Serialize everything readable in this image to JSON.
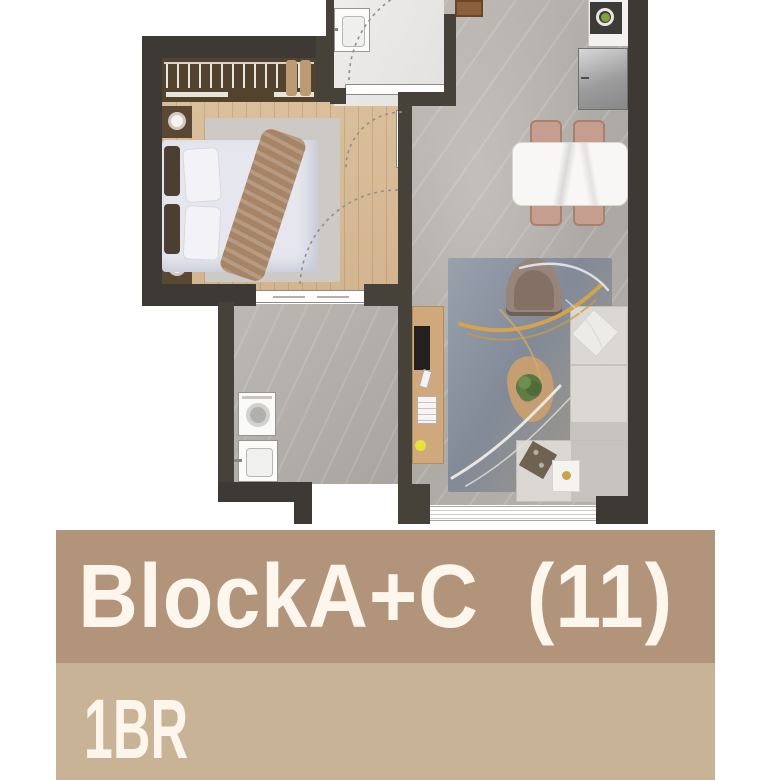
{
  "banner": {
    "block_line": "BlockA+C  (11)",
    "type_line": "1BR",
    "bar1_color": "#b2947a",
    "bar2_color": "#c9b396",
    "text_color": "#fcf6ec"
  },
  "floor_plan": {
    "rooms": [
      "bedroom",
      "wardrobe",
      "bathroom",
      "hallway",
      "entry",
      "kitchen",
      "dining-area",
      "living-area",
      "laundry-bathroom"
    ],
    "furniture": [
      "wardrobe-hangers",
      "double-bed",
      "nightstand-lamps",
      "bathroom-sink",
      "entry-doormat",
      "kitchen-sink",
      "refrigerator",
      "dining-table",
      "dining-chairs",
      "area-rug",
      "armchair",
      "coffee-table",
      "plant",
      "sectional-sofa",
      "side-table",
      "tv-console",
      "washing-machine",
      "laundry-sink",
      "window",
      "door-swing-arcs"
    ],
    "colors": {
      "wall": "#474239",
      "wood_floor": "#d8bd99",
      "tile_floor": "#b6b2ae",
      "bathroom_floor": "#e9e8e5",
      "rug_blue": "#8b92a0",
      "feather_gold": "#d4a34c",
      "accent_yellow": "#e7e33c"
    }
  }
}
